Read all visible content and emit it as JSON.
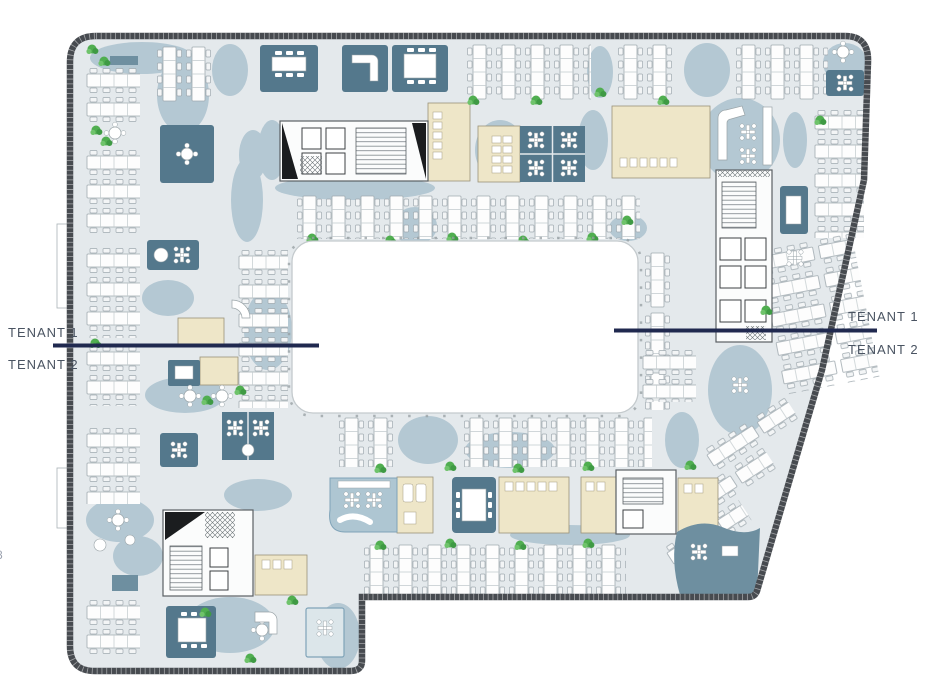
{
  "document": {
    "type": "office-floor-plan",
    "description": "Typical floor plan split between two tenants around a central atrium void"
  },
  "labels": {
    "left": {
      "line1": "TENANT 1",
      "line2": "TENANT 2"
    },
    "right": {
      "line1": "TENANT 1",
      "line2": "TENANT 2"
    },
    "edge_fragment": "8"
  },
  "colors": {
    "background": "#ffffff",
    "floor": "#e4e9ec",
    "circulation": "#b4c8d3",
    "meeting_room": "#54788c",
    "amenity_room": "#eee6c8",
    "accent_teal": "#6e8fa0",
    "perimeter_wall": "#474b50",
    "desk_outline": "#a0aab0",
    "plant_green": "#50ae50",
    "atrium_void": "#ffffff",
    "tenant_divider": "#20294f",
    "label_text": "#4a5462"
  }
}
